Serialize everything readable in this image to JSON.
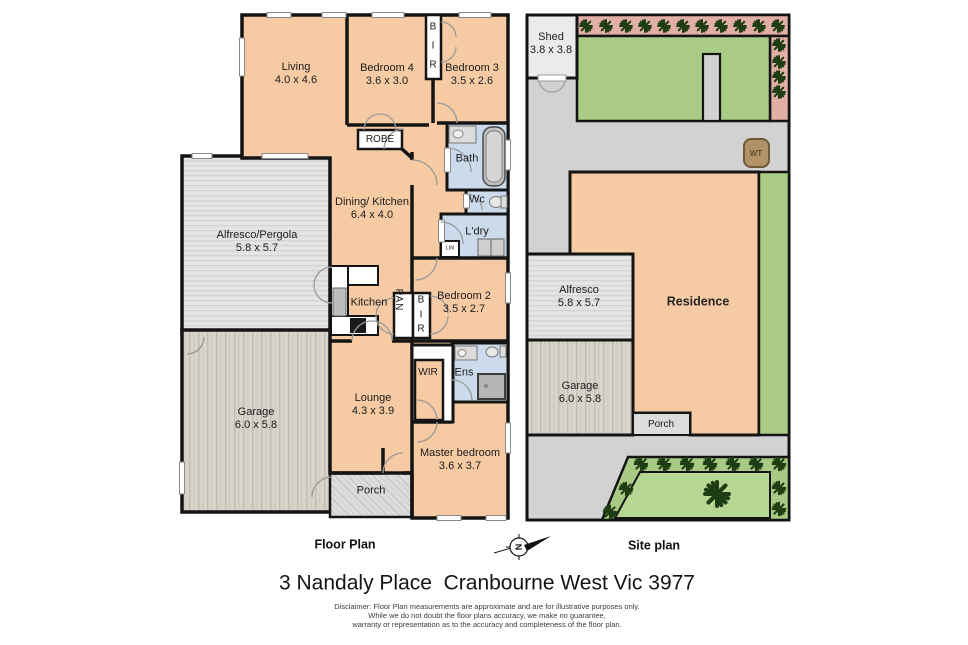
{
  "floor_plan": {
    "caption": "Floor Plan",
    "rooms": {
      "living": {
        "name": "Living",
        "dims": "4.0 x 4.6"
      },
      "bedroom4": {
        "name": "Bedroom 4",
        "dims": "3.6 x 3.0"
      },
      "bedroom3": {
        "name": "Bedroom 3",
        "dims": "3.5 x 2.6"
      },
      "bir_top": {
        "name": "BIR"
      },
      "robe": {
        "name": "ROBE"
      },
      "bath": {
        "name": "Bath"
      },
      "wc": {
        "name": "Wc"
      },
      "ldry": {
        "name": "L'dry"
      },
      "lin": {
        "name": "LIN"
      },
      "dining_kitchen": {
        "name": "Dining/ Kitchen",
        "dims": "6.4 x 4.0"
      },
      "alfresco_pergola": {
        "name": "Alfresco/Pergola",
        "dims": "5.8 x 5.7"
      },
      "kitchen": {
        "name": "Kitchen"
      },
      "pan": {
        "name": "PAN"
      },
      "bir_bed2": {
        "name": "BIR"
      },
      "bedroom2": {
        "name": "Bedroom 2",
        "dims": "3.5 x 2.7"
      },
      "garage": {
        "name": "Garage",
        "dims": "6.0 x 5.8"
      },
      "lounge": {
        "name": "Lounge",
        "dims": "4.3 x 3.9"
      },
      "wir": {
        "name": "WIR"
      },
      "ens": {
        "name": "Ens"
      },
      "master_bedroom": {
        "name": "Master bedroom",
        "dims": "3.6 x 3.7"
      },
      "porch": {
        "name": "Porch"
      }
    }
  },
  "site_plan": {
    "caption": "Site plan",
    "labels": {
      "shed": {
        "name": "Shed",
        "dims": "3.8 x 3.8"
      },
      "water_tank": {
        "name": "WT"
      },
      "alfresco": {
        "name": "Alfresco",
        "dims": "5.8 x 5.7"
      },
      "residence": {
        "name": "Residence"
      },
      "garage": {
        "name": "Garage",
        "dims": "6.0 x 5.8"
      },
      "porch": {
        "name": "Porch"
      }
    }
  },
  "footer": {
    "title": "3 Nandaly Place  Cranbourne West Vic 3977",
    "compass_letter": "N",
    "disclaimer_lines": [
      "Disclaimer: Floor Plan measurements are approximate and are for illustrative purposes only.",
      "While we do not doubt the floor plans accuracy, we make no guarantee,",
      "warranty or representation as to the accuracy and completeness of the floor plan."
    ]
  },
  "colors": {
    "room_orange": "#f6cba3",
    "wet_area_blue": "#cbdbeb",
    "wall_black": "#141414",
    "site_ground_gray": "#d2d2d2",
    "garden_green": "#a9cb86",
    "lawn_green": "#b6d793",
    "border_pink": "#e2afa7",
    "tree_green": "#1f3d12",
    "water_tank_brown": "#b29367"
  }
}
